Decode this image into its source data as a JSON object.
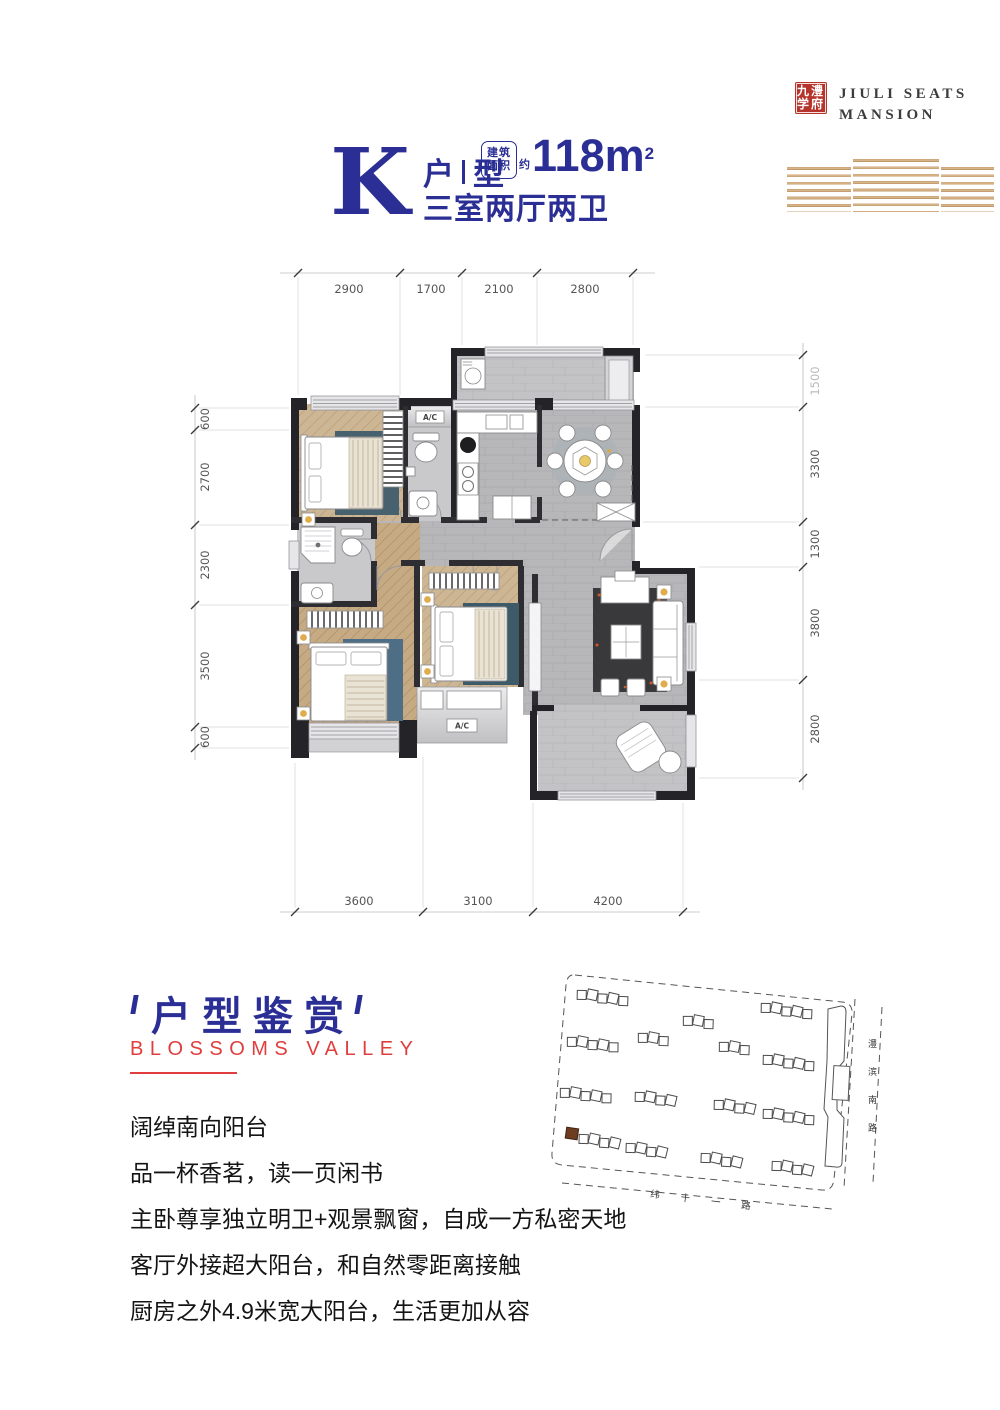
{
  "brand": {
    "logo_row1": "九澧",
    "logo_row2": "学府",
    "name_line1": "JIULI SEATS",
    "name_line2": "MANSION"
  },
  "title": {
    "unit_letter": "K",
    "unit_zh_1": "户",
    "unit_zh_2": "型",
    "area_box_line1": "建筑",
    "area_box_line2": "面积",
    "area_prefix": "约",
    "area_value": "118m",
    "area_sup": "2",
    "rooms": "三室两厅两卫"
  },
  "floorplan": {
    "ac_label": "A/C",
    "dims_top": [
      "2900",
      "1700",
      "2100",
      "2800"
    ],
    "dims_left": [
      "600",
      "2700",
      "2300",
      "3500",
      "600"
    ],
    "dims_right": [
      "1500",
      "3300",
      "1300",
      "3800",
      "2800"
    ],
    "dims_bottom": [
      "3600",
      "3100",
      "4200"
    ]
  },
  "section": {
    "heading": "户型鉴赏",
    "subheading": "BLOSSOMS VALLEY"
  },
  "description": {
    "lines": [
      "阔绰南向阳台",
      "品一杯香茗，读一页闲书",
      "主卧尊享独立明卫+观景飘窗，自成一方私密天地",
      "客厅外接超大阳台，和自然零距离接触",
      "厨房之外4.9米宽大阳台，生活更加从容"
    ]
  },
  "sitemap": {
    "road_bottom": "纬 十 一 路",
    "road_right_1": "澧",
    "road_right_2": "滨",
    "road_right_3": "南",
    "road_right_4": "路"
  },
  "colors": {
    "navy": "#2b2f95",
    "red": "#e03e3e",
    "logo_red": "#b5342c",
    "gold": "#c79d72",
    "highlight_brown": "#6e3d20"
  }
}
